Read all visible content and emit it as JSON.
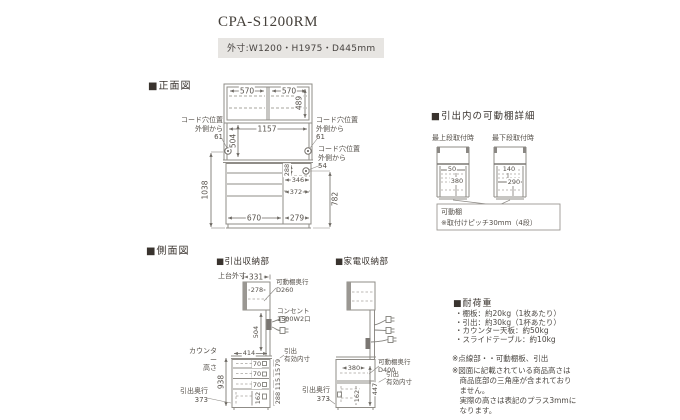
{
  "title": "CPA-S1200RM",
  "outer_size": "外寸:W1200・H1975・D445mm",
  "front": {
    "heading": "■正面図",
    "dim_top_left": "570",
    "dim_top_right": "570",
    "dim_top_height": "489",
    "dim_inner_width": "1157",
    "dim_open_height": "504",
    "cord_hole_left": "コード穴位置\n外側から\n61",
    "cord_hole_right": "コード穴位置\n外側から\n61",
    "cord_hole_right_lower": "コード穴位置\n外側から\n54",
    "dim_lower_height": "1038",
    "dim_right_height": "782",
    "dim_slide_height": "288",
    "dim_slide_width": "346",
    "dim_appliance_width": "372",
    "dim_bottom_left": "670",
    "dim_bottom_right": "279"
  },
  "shelf_detail": {
    "heading": "■引出内の可動棚詳細",
    "top_position_label": "最上段取付時",
    "bottom_position_label": "最下段取付時",
    "top_dim_upper": "50",
    "top_dim_lower": "380",
    "bottom_dim_upper": "140",
    "bottom_dim_lower": "290",
    "note": "可動棚\n※取付けピッチ30mm（4段）"
  },
  "side": {
    "heading": "■側面図",
    "drawer_section": {
      "heading": "■引出収納部",
      "upper_outer_label": "上台外寸",
      "dim_upper_width": "331",
      "dim_shelf_width": "278",
      "shelf_depth_label": "可動棚奥行\nD260",
      "outlet_label": "コンセント\n1500W2口",
      "dim_open_height": "504",
      "counter_height_label": "カウンター\n高さ",
      "dim_counter_depth": "414",
      "dim_counter_height": "938",
      "drawer_inner_label": "引出\n有効内寸",
      "drawer_front_dims": [
        "70",
        "70",
        "70",
        "162"
      ],
      "drawer_inner_dims": [
        "79",
        "115",
        "115",
        "288"
      ],
      "drawer_depth_label": "引出奥行\n373"
    },
    "appliance_section": {
      "heading": "■家電収納部",
      "dim_slide_width": "380",
      "shelf_depth_label": "可動棚奥行\nD400",
      "drawer_inner_label": "引出\n有効内寸",
      "dim_drawer_height": "162",
      "dim_inner_height": "447",
      "drawer_depth_label": "引出奥行\n373"
    }
  },
  "load": {
    "heading": "■耐荷重",
    "items": [
      "・棚板：約20kg（1枚あたり）",
      "・引出：約30kg（1杯あたり）",
      "・カウンター天板：約50kg",
      "・スライドテーブル：約10kg"
    ],
    "note_dotted": "※点線部・・可動棚板、引出",
    "note_height": "※図面に記載されている商品高さは\n　商品底部の三角座が含まれており\n　ません。\n　実際の高さは表記のプラス3mmに\n　なります。"
  }
}
